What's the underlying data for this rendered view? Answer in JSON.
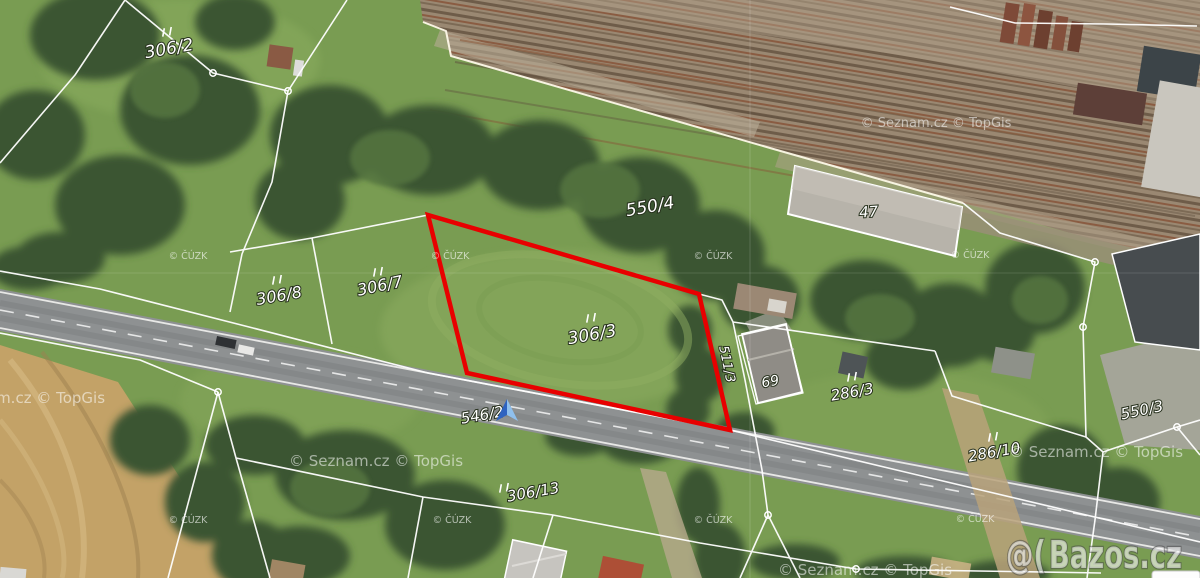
{
  "map_provider": {
    "watermark": "© Seznam.cz  © TopGis",
    "cadastre_watermark": "© ČÚZK"
  },
  "listing_watermark": {
    "logo": "@(",
    "name": "Bazos.cz"
  },
  "parcel_labels": {
    "p306_2": "306/2",
    "p550_4": "550/4",
    "p306_8": "306/8",
    "p306_7": "306/7",
    "p306_3": "306/3",
    "p511_3": "511/3",
    "p550_3": "550/3",
    "p286_3": "286/3",
    "p286_10": "286/10",
    "p306_13": "306/13",
    "p546_2": "546/2"
  },
  "building_labels": {
    "b47": "47",
    "b69": "69"
  },
  "highlight": {
    "color": "#e80000",
    "parcel": "306/3"
  },
  "boundary_color": "#ffffff"
}
